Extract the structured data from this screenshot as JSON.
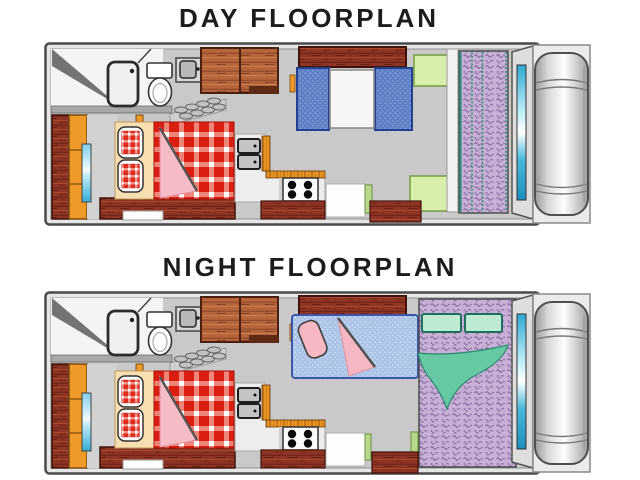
{
  "page": {
    "background": "#ffffff",
    "width": 640,
    "height": 480
  },
  "plans": {
    "day": {
      "title": "DAY FLOORPLAN",
      "items": [
        "over-cab-double-bed",
        "wardrobe",
        "shower",
        "toilet",
        "bathroom-sink",
        "entry-steps",
        "overhead-cabinets",
        "dinette-benches",
        "dinette-table",
        "kitchen-sink",
        "stove-4-burner",
        "kitchen-counter",
        "entry-walkway",
        "side-cushion-top",
        "side-cushion-bottom",
        "rear-sofa-folded",
        "rear-door",
        "truck-cab"
      ]
    },
    "night": {
      "title": "NIGHT FLOORPLAN",
      "items": [
        "over-cab-double-bed",
        "wardrobe",
        "shower",
        "toilet",
        "bathroom-sink",
        "entry-steps",
        "overhead-cabinets",
        "dinette-converted-bed",
        "pink-pillow",
        "pink-folded-blanket",
        "kitchen-sink",
        "stove-4-burner",
        "kitchen-counter",
        "entry-walkway",
        "rear-double-bed",
        "mint-pillows",
        "teal-blanket",
        "rear-door",
        "truck-cab"
      ]
    }
  },
  "palette": {
    "title_color": "#1c1c1c",
    "floor_gray": "#c9c9c9",
    "wall_gray": "#e6e6e6",
    "outline": "#4a4a4a",
    "wood_maroon": "#8e3424",
    "wood_sienna": "#b5643c",
    "trim_orange": "#e89422",
    "gingham_red": "#da1f12",
    "blanket_pink": "#f6b8c2",
    "sheet_cream": "#f7dfb2",
    "denim_blue_day": "#5d80c6",
    "denim_blue_night": "#aac3e7",
    "mattress_purple": "#c7b0d6",
    "cushion_green": "#d8efac",
    "pillow_mint": "#bcead2",
    "blanket_teal": "#66c9a4",
    "window_cyan": "#2fa8d2",
    "cab_gray": "#c4c4c4"
  }
}
